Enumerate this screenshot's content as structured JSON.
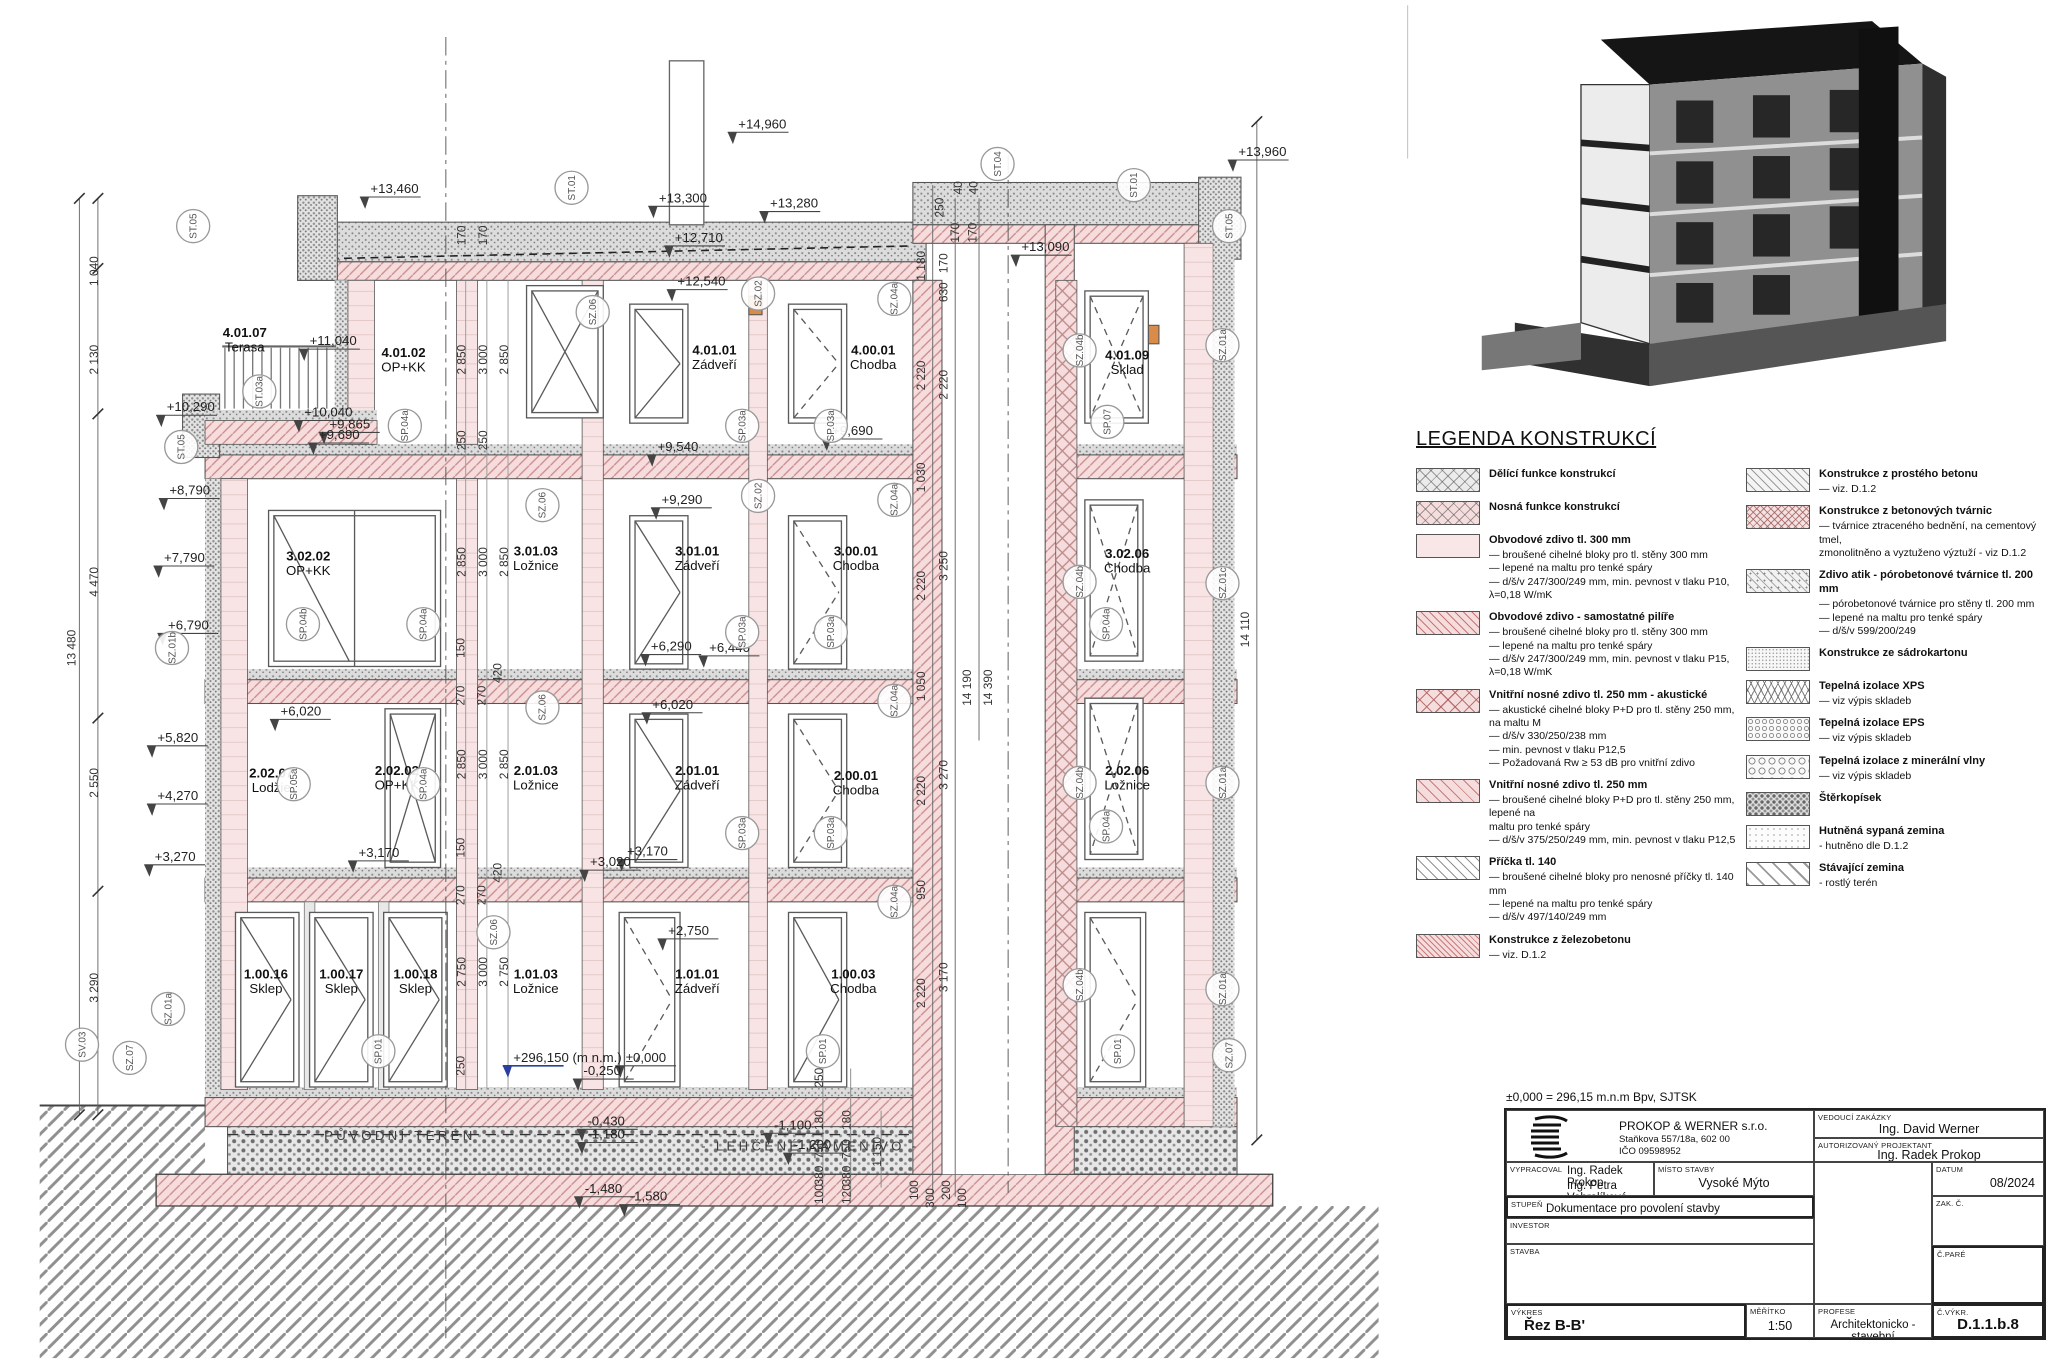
{
  "section": {
    "rooms": [
      {
        "id": "4.01.07",
        "name": "Terasa",
        "x": 185,
        "y": 255
      },
      {
        "id": "4.01.02",
        "name": "OP+KK",
        "x": 305,
        "y": 270
      },
      {
        "id": "4.01.01",
        "name": "Zádveří",
        "x": 540,
        "y": 268
      },
      {
        "id": "4.00.01",
        "name": "Chodba",
        "x": 660,
        "y": 268
      },
      {
        "id": "4.01.09",
        "name": "Sklad",
        "x": 852,
        "y": 272
      },
      {
        "id": "3.02.02",
        "name": "OP+KK",
        "x": 233,
        "y": 424
      },
      {
        "id": "3.01.03",
        "name": "Ložnice",
        "x": 405,
        "y": 420
      },
      {
        "id": "3.01.01",
        "name": "Zádveří",
        "x": 527,
        "y": 420
      },
      {
        "id": "3.00.01",
        "name": "Chodba",
        "x": 647,
        "y": 420
      },
      {
        "id": "3.02.06",
        "name": "Chodba",
        "x": 852,
        "y": 422
      },
      {
        "id": "2.02.07",
        "name": "Lodžie",
        "x": 205,
        "y": 588
      },
      {
        "id": "2.02.02",
        "name": "OP+KK",
        "x": 300,
        "y": 586
      },
      {
        "id": "2.01.03",
        "name": "Ložnice",
        "x": 405,
        "y": 586
      },
      {
        "id": "2.01.01",
        "name": "Zádveří",
        "x": 527,
        "y": 586
      },
      {
        "id": "2.00.01",
        "name": "Chodba",
        "x": 647,
        "y": 590
      },
      {
        "id": "2.02.06",
        "name": "Ložnice",
        "x": 852,
        "y": 586
      },
      {
        "id": "1.00.16",
        "name": "Sklep",
        "x": 201,
        "y": 740
      },
      {
        "id": "1.00.17",
        "name": "Sklep",
        "x": 258,
        "y": 740
      },
      {
        "id": "1.00.18",
        "name": "Sklep",
        "x": 314,
        "y": 740
      },
      {
        "id": "1.01.03",
        "name": "Ložnice",
        "x": 405,
        "y": 740
      },
      {
        "id": "1.01.01",
        "name": "Zádveří",
        "x": 527,
        "y": 740
      },
      {
        "id": "1.00.03",
        "name": "Chodba",
        "x": 645,
        "y": 740
      }
    ],
    "levels": [
      {
        "t": "+14,960",
        "x": 558,
        "y": 97
      },
      {
        "t": "+13,460",
        "x": 280,
        "y": 146
      },
      {
        "t": "+13,300",
        "x": 498,
        "y": 153
      },
      {
        "t": "+13,280",
        "x": 582,
        "y": 157
      },
      {
        "t": "+13,960",
        "x": 936,
        "y": 118
      },
      {
        "t": "+13,090",
        "x": 772,
        "y": 190
      },
      {
        "t": "+12,710",
        "x": 510,
        "y": 183
      },
      {
        "t": "+12,540",
        "x": 512,
        "y": 216
      },
      {
        "t": "+11,040",
        "x": 234,
        "y": 261
      },
      {
        "t": "+10,290",
        "x": 126,
        "y": 311
      },
      {
        "t": "+10,040",
        "x": 230,
        "y": 315
      },
      {
        "t": "+9,865",
        "x": 249,
        "y": 324
      },
      {
        "t": "+9,690",
        "x": 241,
        "y": 332
      },
      {
        "t": "+9,540",
        "x": 497,
        "y": 341
      },
      {
        "t": "+9,690",
        "x": 629,
        "y": 329
      },
      {
        "t": "+9,290",
        "x": 500,
        "y": 381
      },
      {
        "t": "+8,790",
        "x": 128,
        "y": 374
      },
      {
        "t": "+7,790",
        "x": 124,
        "y": 425
      },
      {
        "t": "+6,790",
        "x": 127,
        "y": 476
      },
      {
        "t": "+6,440",
        "x": 536,
        "y": 493
      },
      {
        "t": "+6,290",
        "x": 492,
        "y": 492
      },
      {
        "t": "+6,020",
        "x": 212,
        "y": 541
      },
      {
        "t": "+6,020",
        "x": 493,
        "y": 536
      },
      {
        "t": "+5,820",
        "x": 119,
        "y": 561
      },
      {
        "t": "+4,270",
        "x": 119,
        "y": 605
      },
      {
        "t": "+3,270",
        "x": 117,
        "y": 651
      },
      {
        "t": "+3,170",
        "x": 271,
        "y": 648
      },
      {
        "t": "+3,170",
        "x": 474,
        "y": 647
      },
      {
        "t": "+3,020",
        "x": 446,
        "y": 655
      },
      {
        "t": "+2,750",
        "x": 505,
        "y": 707
      },
      {
        "t": "±0,000",
        "x": 473,
        "y": 803
      },
      {
        "t": "-0,250",
        "x": 441,
        "y": 813
      },
      {
        "t": "-0,430",
        "x": 444,
        "y": 851
      },
      {
        "t": "-1,180",
        "x": 444,
        "y": 861
      },
      {
        "t": "-1,480",
        "x": 442,
        "y": 902
      },
      {
        "t": "-1,580",
        "x": 476,
        "y": 908
      },
      {
        "t": "-1,100",
        "x": 585,
        "y": 854
      },
      {
        "t": "-1,200",
        "x": 600,
        "y": 869
      }
    ],
    "datum": {
      "t": "+296,150 (m n.m.)",
      "x": 388,
      "y": 803,
      "c": "#2b3f9e"
    },
    "dims": [
      {
        "t": "1 040",
        "x": 74,
        "y": 205
      },
      {
        "t": "2 130",
        "x": 74,
        "y": 272
      },
      {
        "t": "4 470",
        "x": 74,
        "y": 440
      },
      {
        "t": "2 550",
        "x": 74,
        "y": 592
      },
      {
        "t": "3 290",
        "x": 74,
        "y": 747
      },
      {
        "t": "13 480",
        "x": 57,
        "y": 490
      },
      {
        "t": "170",
        "x": 352,
        "y": 178
      },
      {
        "t": "170",
        "x": 368,
        "y": 178
      },
      {
        "t": "2 850",
        "x": 352,
        "y": 272
      },
      {
        "t": "3 000",
        "x": 368,
        "y": 272
      },
      {
        "t": "2 850",
        "x": 384,
        "y": 272
      },
      {
        "t": "250",
        "x": 352,
        "y": 333
      },
      {
        "t": "250",
        "x": 368,
        "y": 333
      },
      {
        "t": "2 850",
        "x": 352,
        "y": 425
      },
      {
        "t": "3 000",
        "x": 368,
        "y": 425
      },
      {
        "t": "2 850",
        "x": 384,
        "y": 425
      },
      {
        "t": "150",
        "x": 351,
        "y": 490
      },
      {
        "t": "420",
        "x": 379,
        "y": 509
      },
      {
        "t": "270",
        "x": 351,
        "y": 526
      },
      {
        "t": "270",
        "x": 367,
        "y": 526
      },
      {
        "t": "2 850",
        "x": 352,
        "y": 578
      },
      {
        "t": "3 000",
        "x": 368,
        "y": 578
      },
      {
        "t": "2 850",
        "x": 384,
        "y": 578
      },
      {
        "t": "150",
        "x": 351,
        "y": 641
      },
      {
        "t": "420",
        "x": 379,
        "y": 660
      },
      {
        "t": "270",
        "x": 351,
        "y": 677
      },
      {
        "t": "270",
        "x": 367,
        "y": 677
      },
      {
        "t": "2 750",
        "x": 352,
        "y": 735
      },
      {
        "t": "3 000",
        "x": 368,
        "y": 735
      },
      {
        "t": "2 750",
        "x": 384,
        "y": 735
      },
      {
        "t": "250",
        "x": 351,
        "y": 806
      },
      {
        "t": "40",
        "x": 727,
        "y": 142
      },
      {
        "t": "40",
        "x": 739,
        "y": 142
      },
      {
        "t": "250",
        "x": 713,
        "y": 157
      },
      {
        "t": "170",
        "x": 725,
        "y": 176
      },
      {
        "t": "170",
        "x": 738,
        "y": 176
      },
      {
        "t": "1 180",
        "x": 699,
        "y": 201
      },
      {
        "t": "170",
        "x": 716,
        "y": 199
      },
      {
        "t": "630",
        "x": 716,
        "y": 221
      },
      {
        "t": "2 220",
        "x": 699,
        "y": 284
      },
      {
        "t": "2 220",
        "x": 716,
        "y": 291
      },
      {
        "t": "1 030",
        "x": 699,
        "y": 361
      },
      {
        "t": "3 250",
        "x": 716,
        "y": 428
      },
      {
        "t": "2 220",
        "x": 699,
        "y": 443
      },
      {
        "t": "1 050",
        "x": 699,
        "y": 519
      },
      {
        "t": "14 190",
        "x": 734,
        "y": 520
      },
      {
        "t": "14 390",
        "x": 750,
        "y": 520
      },
      {
        "t": "3 270",
        "x": 716,
        "y": 586
      },
      {
        "t": "2 220",
        "x": 699,
        "y": 598
      },
      {
        "t": "950",
        "x": 699,
        "y": 673
      },
      {
        "t": "3 170",
        "x": 716,
        "y": 739
      },
      {
        "t": "2 220",
        "x": 699,
        "y": 751
      },
      {
        "t": "14 110",
        "x": 944,
        "y": 476
      },
      {
        "t": "250",
        "x": 622,
        "y": 815
      },
      {
        "t": "180",
        "x": 622,
        "y": 847
      },
      {
        "t": "750",
        "x": 622,
        "y": 869
      },
      {
        "t": "380",
        "x": 622,
        "y": 889
      },
      {
        "t": "100",
        "x": 622,
        "y": 903
      },
      {
        "t": "180",
        "x": 643,
        "y": 847
      },
      {
        "t": "750",
        "x": 643,
        "y": 869
      },
      {
        "t": "380",
        "x": 643,
        "y": 889
      },
      {
        "t": "120",
        "x": 643,
        "y": 903
      },
      {
        "t": "1 150",
        "x": 666,
        "y": 871
      },
      {
        "t": "100",
        "x": 694,
        "y": 900
      },
      {
        "t": "300",
        "x": 706,
        "y": 906
      },
      {
        "t": "200",
        "x": 718,
        "y": 900
      },
      {
        "t": "100",
        "x": 730,
        "y": 906
      }
    ],
    "markers": [
      {
        "t": "ST.05",
        "x": 146,
        "y": 171
      },
      {
        "t": "ST.01",
        "x": 432,
        "y": 142
      },
      {
        "t": "ST.04",
        "x": 754,
        "y": 124
      },
      {
        "t": "ST.01",
        "x": 857,
        "y": 140
      },
      {
        "t": "ST.05",
        "x": 929,
        "y": 171
      },
      {
        "t": "SZ.06",
        "x": 448,
        "y": 236
      },
      {
        "t": "SZ.02",
        "x": 573,
        "y": 222
      },
      {
        "t": "SZ.04a",
        "x": 676,
        "y": 226
      },
      {
        "t": "ST.03a",
        "x": 196,
        "y": 296
      },
      {
        "t": "SP.04a",
        "x": 306,
        "y": 322
      },
      {
        "t": "SP.03a",
        "x": 561,
        "y": 322
      },
      {
        "t": "SP.03a",
        "x": 628,
        "y": 322
      },
      {
        "t": "SZ.04b",
        "x": 816,
        "y": 265
      },
      {
        "t": "SZ.01a",
        "x": 924,
        "y": 261
      },
      {
        "t": "SP.07",
        "x": 837,
        "y": 319
      },
      {
        "t": "ST.05",
        "x": 137,
        "y": 338
      },
      {
        "t": "SZ.06",
        "x": 410,
        "y": 382
      },
      {
        "t": "SZ.02",
        "x": 573,
        "y": 375
      },
      {
        "t": "SZ.04a",
        "x": 676,
        "y": 378
      },
      {
        "t": "SZ.01b",
        "x": 130,
        "y": 490
      },
      {
        "t": "SP.04b",
        "x": 229,
        "y": 472
      },
      {
        "t": "SP.04a",
        "x": 320,
        "y": 472
      },
      {
        "t": "SP.03a",
        "x": 561,
        "y": 478
      },
      {
        "t": "SP.03a",
        "x": 628,
        "y": 478
      },
      {
        "t": "SZ.04b",
        "x": 816,
        "y": 440
      },
      {
        "t": "SZ.01c",
        "x": 924,
        "y": 441
      },
      {
        "t": "SP.04a",
        "x": 836,
        "y": 472
      },
      {
        "t": "SZ.06",
        "x": 410,
        "y": 535
      },
      {
        "t": "SZ.04a",
        "x": 676,
        "y": 530
      },
      {
        "t": "SP.05a",
        "x": 222,
        "y": 593
      },
      {
        "t": "SP.04a",
        "x": 320,
        "y": 593
      },
      {
        "t": "SP.03a",
        "x": 561,
        "y": 630
      },
      {
        "t": "SP.03a",
        "x": 628,
        "y": 630
      },
      {
        "t": "SZ.04b",
        "x": 816,
        "y": 592
      },
      {
        "t": "SZ.01a",
        "x": 924,
        "y": 592
      },
      {
        "t": "SP.04a",
        "x": 836,
        "y": 625
      },
      {
        "t": "SZ.06",
        "x": 373,
        "y": 705
      },
      {
        "t": "SZ.04a",
        "x": 676,
        "y": 682
      },
      {
        "t": "SZ.01a",
        "x": 127,
        "y": 763
      },
      {
        "t": "SP.01",
        "x": 286,
        "y": 795
      },
      {
        "t": "SP.01",
        "x": 622,
        "y": 795
      },
      {
        "t": "SP.01",
        "x": 845,
        "y": 795
      },
      {
        "t": "SZ.04b",
        "x": 816,
        "y": 745
      },
      {
        "t": "SZ.01a",
        "x": 924,
        "y": 748
      },
      {
        "t": "SV.03",
        "x": 62,
        "y": 790
      },
      {
        "t": "SZ.07",
        "x": 98,
        "y": 800
      },
      {
        "t": "SZ.07",
        "x": 929,
        "y": 798
      }
    ],
    "ground_labels": [
      {
        "t": "PŮVODNÍ TERÉN",
        "x": 245,
        "y": 862
      },
      {
        "t": "- LEHČENÉ KAMENIVO -",
        "x": 530,
        "y": 870
      }
    ]
  },
  "legend": {
    "title": "LEGENDA KONSTRUKCÍ",
    "left": [
      {
        "p": "p-div",
        "title": "Dělící funkce konstrukcí",
        "lines": []
      },
      {
        "p": "p-nos",
        "title": "Nosná funkce konstrukcí",
        "lines": []
      },
      {
        "p": "p-obv",
        "title": "Obvodové zdivo tl. 300 mm",
        "lines": [
          "— broušené cihelné bloky pro tl. stěny 300 mm",
          "— lepené na maltu pro tenké spáry",
          "— d/š/v 247/300/249 mm, min. pevnost v tlaku P10, λ=0,18 W/mK"
        ]
      },
      {
        "p": "p-pil",
        "title": "Obvodové zdivo - samostatné pilíře",
        "lines": [
          "— broušené cihelné bloky pro tl. stěny 300 mm",
          "— lepené na maltu pro tenké spáry",
          "— d/š/v 247/300/249 mm, min. pevnost v tlaku P15, λ=0,18 W/mK"
        ]
      },
      {
        "p": "p-vak",
        "title": "Vnitřní nosné zdivo tl. 250 mm - akustické",
        "lines": [
          "— akustické cihelné bloky P+D pro tl. stěny 250 mm, na maltu M",
          "— d/š/v 330/250/238 mm",
          "— min. pevnost v tlaku P12,5",
          "— Požadovaná Rw ≥ 53 dB pro vnitřní zdivo"
        ]
      },
      {
        "p": "p-v25",
        "title": "Vnitřní nosné zdivo tl. 250 mm",
        "lines": [
          "— broušené cihelné bloky P+D pro tl. stěny 250 mm, lepené na",
          "maltu pro tenké spáry",
          "— d/š/v 375/250/249 mm, min. pevnost v tlaku P12,5"
        ]
      },
      {
        "p": "p-pri",
        "title": "Příčka tl. 140",
        "lines": [
          "— broušené cihelné bloky pro nenosné příčky tl. 140 mm",
          "— lepené na maltu pro tenké spáry",
          "— d/š/v 497/140/249 mm"
        ]
      },
      {
        "p": "p-zb",
        "title": "Konstrukce z železobetonu",
        "lines": [
          "— viz. D.1.2"
        ]
      }
    ],
    "right": [
      {
        "p": "p-pb",
        "title": "Konstrukce z prostého betonu",
        "lines": [
          "— viz. D.1.2"
        ]
      },
      {
        "p": "p-bt",
        "title": "Konstrukce z betonových tvárnic",
        "lines": [
          "— tvárnice ztraceného bednění, na cementový tmel,",
          "zmonolitněno a vyztuženo výztuží - viz D.1.2"
        ]
      },
      {
        "p": "p-por",
        "title": "Zdivo atik - pórobetonové tvárnice tl. 200 mm",
        "lines": [
          "— pórobetonové tvárnice pro stěny tl. 200 mm",
          "— lepené na maltu pro tenké spáry",
          "— d/š/v 599/200/249"
        ]
      },
      {
        "p": "p-sad",
        "title": "Konstrukce ze sádrokartonu",
        "lines": []
      },
      {
        "p": "p-xps",
        "title": "Tepelná izolace XPS",
        "lines": [
          "— viz výpis skladeb"
        ]
      },
      {
        "p": "p-eps",
        "title": "Tepelná izolace EPS",
        "lines": [
          "— viz výpis skladeb"
        ]
      },
      {
        "p": "p-min",
        "title": "Tepelná izolace z minerální vlny",
        "lines": [
          "— viz výpis skladeb"
        ]
      },
      {
        "p": "p-ste",
        "title": "Štěrkopísek",
        "lines": []
      },
      {
        "p": "p-hut",
        "title": "Hutněná sypaná zemina",
        "lines": [
          "- hutněno dle D.1.2"
        ]
      },
      {
        "p": "p-sta",
        "title": "Stávající zemina",
        "lines": [
          "- rostlý terén"
        ]
      }
    ]
  },
  "titleblock": {
    "datum_note": "±0,000 = 296,15 m.n.m Bpv, SJTSK",
    "company": {
      "name": "PROKOP & WERNER s.r.o.",
      "addr": "Staňkova 557/18a, 602 00",
      "ico": "IČO 09598952"
    },
    "labels": {
      "vedouci": "VEDOUCÍ ZAKÁZKY",
      "autoriz": "AUTORIZOVANÝ PROJEKTANT",
      "vypracoval": "VYPRACOVAL",
      "misto": "MÍSTO STAVBY",
      "datum": "DATUM",
      "stupen": "STUPEŇ",
      "zakc": "ZAK. Č.",
      "investor": "INVESTOR",
      "cpare": "Č.PARÉ",
      "stavba": "STAVBA",
      "vykres": "VÝKRES",
      "meritko": "MĚŘÍTKO",
      "profese": "PROFESE",
      "cvykr": "Č.VÝKR."
    },
    "values": {
      "vedouci": "Ing. David Werner",
      "autoriz": "Ing. Radek Prokop",
      "vypracoval1": "Ing. Radek Prokop",
      "vypracoval2": "Ing. Petra Vohralíková",
      "misto": "Vysoké Mýto",
      "datum": "08/2024",
      "stupen": "Dokumentace pro povolení stavby",
      "zakc": "",
      "investor": "",
      "cpare": "",
      "stavba": "",
      "vykres": "Řez B-B'",
      "meritko": "1:50",
      "profese": "Architektonicko - stavební",
      "cvykr": "D.1.1.b.8"
    }
  }
}
